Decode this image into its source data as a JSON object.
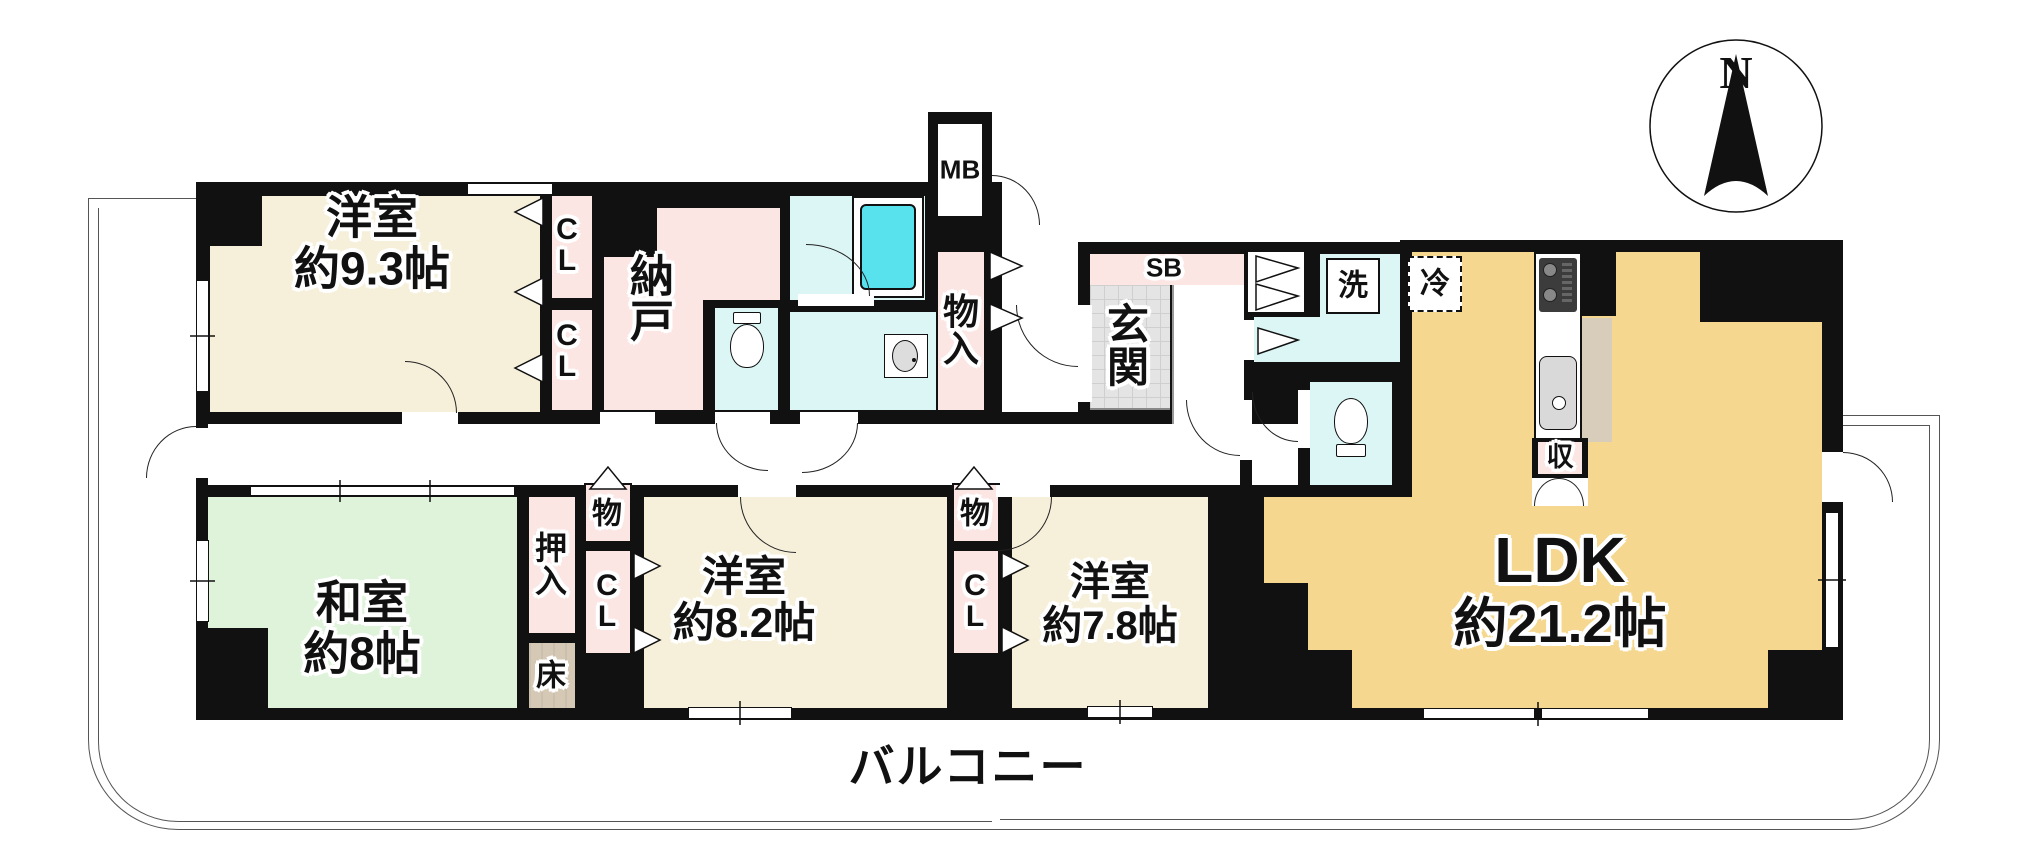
{
  "compass": {
    "label": "N"
  },
  "balcony": {
    "label": "バルコニー"
  },
  "rooms": {
    "west_bedroom": {
      "name": "洋室",
      "size": "約9.3帖"
    },
    "storage_room": {
      "name": "納戸"
    },
    "tatami_room": {
      "name": "和室",
      "size": "約8帖"
    },
    "center_bedroom": {
      "name": "洋室",
      "size": "約8.2帖"
    },
    "east_bedroom": {
      "name": "洋室",
      "size": "約7.8帖"
    },
    "ldk": {
      "name": "LDK",
      "size": "約21.2帖"
    },
    "entrance": {
      "name": "玄関"
    }
  },
  "closets": {
    "cl": "CL",
    "oshiire": "押入",
    "mono": "物",
    "monoire": "物入",
    "tokonoma": "床",
    "shoebox": "SB",
    "meterbox": "MB",
    "kitchen_storage": "収"
  },
  "fixtures": {
    "washer": "洗",
    "fridge": "冷"
  },
  "colors": {
    "wall": "#111111",
    "western_room": "#F6EFDA",
    "ldk": "#F5D78F",
    "closet_pink": "#FBE6E4",
    "tatami_green": "#DFF3DB",
    "wet_cyan": "#DCF5F5",
    "bathtub_cyan": "#57E2EE",
    "entrance_tile": "#E4E4E4",
    "tokonoma_tan": "#D5C9B6",
    "counter_tan": "#D8CCBA"
  }
}
